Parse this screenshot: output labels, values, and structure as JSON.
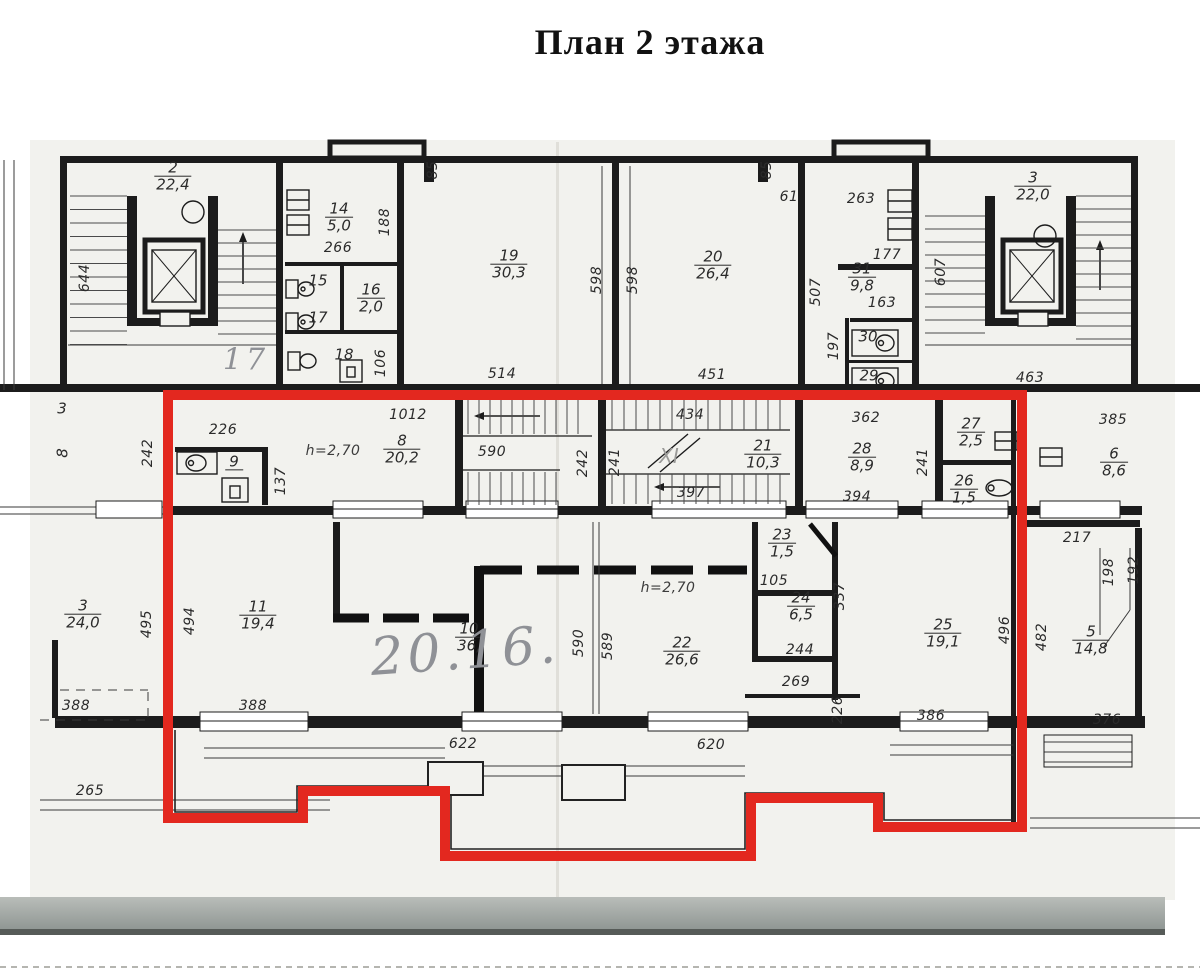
{
  "title": "План 2 этажа",
  "colors": {
    "outline_red": "#e3281f",
    "ink": "#1c1c1c",
    "paper": "#f2f2ee",
    "pencil": "#8f9196"
  },
  "rooms": [
    {
      "number": "2",
      "area": "22,4",
      "x": 173,
      "y": 177
    },
    {
      "number": "14",
      "area": "5,0",
      "x": 339,
      "y": 218
    },
    {
      "number": "16",
      "area": "2,0",
      "x": 371,
      "y": 299
    },
    {
      "number": "19",
      "area": "30,3",
      "x": 509,
      "y": 265
    },
    {
      "number": "20",
      "area": "26,4",
      "x": 713,
      "y": 266
    },
    {
      "number": "31",
      "area": "9,8",
      "x": 862,
      "y": 278
    },
    {
      "number": "3",
      "area": "22,0",
      "x": 1033,
      "y": 187
    },
    {
      "number": "9",
      "area": "",
      "x": 234,
      "y": 464
    },
    {
      "number": "8",
      "area": "20,2",
      "x": 402,
      "y": 450
    },
    {
      "number": "21",
      "area": "10,3",
      "x": 763,
      "y": 455
    },
    {
      "number": "28",
      "area": "8,9",
      "x": 862,
      "y": 458
    },
    {
      "number": "27",
      "area": "2,5",
      "x": 971,
      "y": 433
    },
    {
      "number": "26",
      "area": "1,5",
      "x": 964,
      "y": 490
    },
    {
      "number": "6",
      "area": "8,6",
      "x": 1114,
      "y": 463
    },
    {
      "number": "3",
      "area": "24,0",
      "x": 83,
      "y": 615
    },
    {
      "number": "11",
      "area": "19,4",
      "x": 258,
      "y": 616
    },
    {
      "number": "10",
      "area": "36,",
      "x": 469,
      "y": 638
    },
    {
      "number": "22",
      "area": "26,6",
      "x": 682,
      "y": 652
    },
    {
      "number": "23",
      "area": "1,5",
      "x": 782,
      "y": 544
    },
    {
      "number": "24",
      "area": "6,5",
      "x": 801,
      "y": 607
    },
    {
      "number": "25",
      "area": "19,1",
      "x": 943,
      "y": 634
    },
    {
      "number": "5",
      "area": "14,8",
      "x": 1091,
      "y": 641
    }
  ],
  "plain_numbers": [
    {
      "text": "15",
      "x": 318,
      "y": 281
    },
    {
      "text": "17",
      "x": 318,
      "y": 318
    },
    {
      "text": "18",
      "x": 344,
      "y": 355
    },
    {
      "text": "30",
      "x": 868,
      "y": 337
    },
    {
      "text": "29",
      "x": 869,
      "y": 376
    },
    {
      "text": "3",
      "x": 62,
      "y": 409
    },
    {
      "text": "8",
      "x": 63,
      "y": 453,
      "v": true
    }
  ],
  "dimensions": [
    {
      "text": "644",
      "x": 85,
      "y": 278,
      "v": true
    },
    {
      "text": "266",
      "x": 338,
      "y": 248
    },
    {
      "text": "188",
      "x": 385,
      "y": 222,
      "v": true
    },
    {
      "text": "106",
      "x": 381,
      "y": 363,
      "v": true
    },
    {
      "text": "85",
      "x": 433,
      "y": 170,
      "v": true
    },
    {
      "text": "85",
      "x": 767,
      "y": 170,
      "v": true
    },
    {
      "text": "514",
      "x": 502,
      "y": 374
    },
    {
      "text": "598",
      "x": 597,
      "y": 280,
      "v": true
    },
    {
      "text": "598",
      "x": 633,
      "y": 280,
      "v": true
    },
    {
      "text": "451",
      "x": 712,
      "y": 375
    },
    {
      "text": "61",
      "x": 789,
      "y": 197
    },
    {
      "text": "263",
      "x": 861,
      "y": 199
    },
    {
      "text": "507",
      "x": 816,
      "y": 292,
      "v": true
    },
    {
      "text": "177",
      "x": 887,
      "y": 255
    },
    {
      "text": "163",
      "x": 882,
      "y": 303
    },
    {
      "text": "197",
      "x": 834,
      "y": 346,
      "v": true
    },
    {
      "text": "607",
      "x": 941,
      "y": 272,
      "v": true
    },
    {
      "text": "463",
      "x": 1030,
      "y": 378
    },
    {
      "text": "242",
      "x": 148,
      "y": 453,
      "v": true
    },
    {
      "text": "226",
      "x": 223,
      "y": 430
    },
    {
      "text": "137",
      "x": 281,
      "y": 481,
      "v": true
    },
    {
      "text": "1012",
      "x": 408,
      "y": 415
    },
    {
      "text": "590",
      "x": 492,
      "y": 452
    },
    {
      "text": "242",
      "x": 583,
      "y": 463,
      "v": true
    },
    {
      "text": "241",
      "x": 615,
      "y": 462,
      "v": true
    },
    {
      "text": "434",
      "x": 690,
      "y": 415
    },
    {
      "text": "397",
      "x": 691,
      "y": 493
    },
    {
      "text": "362",
      "x": 866,
      "y": 418
    },
    {
      "text": "394",
      "x": 857,
      "y": 497
    },
    {
      "text": "241",
      "x": 923,
      "y": 462,
      "v": true
    },
    {
      "text": "385",
      "x": 1113,
      "y": 420
    },
    {
      "text": "495",
      "x": 147,
      "y": 624,
      "v": true
    },
    {
      "text": "494",
      "x": 190,
      "y": 621,
      "v": true
    },
    {
      "text": "590",
      "x": 579,
      "y": 643,
      "v": true
    },
    {
      "text": "589",
      "x": 608,
      "y": 646,
      "v": true
    },
    {
      "text": "105",
      "x": 774,
      "y": 581
    },
    {
      "text": "337",
      "x": 840,
      "y": 596,
      "v": true
    },
    {
      "text": "244",
      "x": 800,
      "y": 650
    },
    {
      "text": "269",
      "x": 796,
      "y": 682
    },
    {
      "text": "496",
      "x": 1005,
      "y": 630,
      "v": true
    },
    {
      "text": "482",
      "x": 1042,
      "y": 637,
      "v": true
    },
    {
      "text": "217",
      "x": 1077,
      "y": 538
    },
    {
      "text": "198",
      "x": 1109,
      "y": 572,
      "v": true
    },
    {
      "text": "192",
      "x": 1134,
      "y": 570,
      "v": true
    },
    {
      "text": "388",
      "x": 76,
      "y": 706
    },
    {
      "text": "388",
      "x": 253,
      "y": 706
    },
    {
      "text": "265",
      "x": 90,
      "y": 791
    },
    {
      "text": "622",
      "x": 463,
      "y": 744
    },
    {
      "text": "620",
      "x": 711,
      "y": 745
    },
    {
      "text": "226",
      "x": 838,
      "y": 710,
      "v": true
    },
    {
      "text": "386",
      "x": 931,
      "y": 716
    },
    {
      "text": "376",
      "x": 1107,
      "y": 720
    }
  ],
  "notes": [
    {
      "text": "h=2,70",
      "x": 333,
      "y": 451
    },
    {
      "text": "h=2,70",
      "x": 668,
      "y": 588
    },
    {
      "text": "XI",
      "x": 669,
      "y": 456,
      "muted": true
    }
  ],
  "handwritten": [
    {
      "text": "17",
      "x": 246,
      "y": 361,
      "size": 30
    },
    {
      "text": "20.16.",
      "x": 465,
      "y": 652,
      "size": 52,
      "rot": -4
    }
  ]
}
